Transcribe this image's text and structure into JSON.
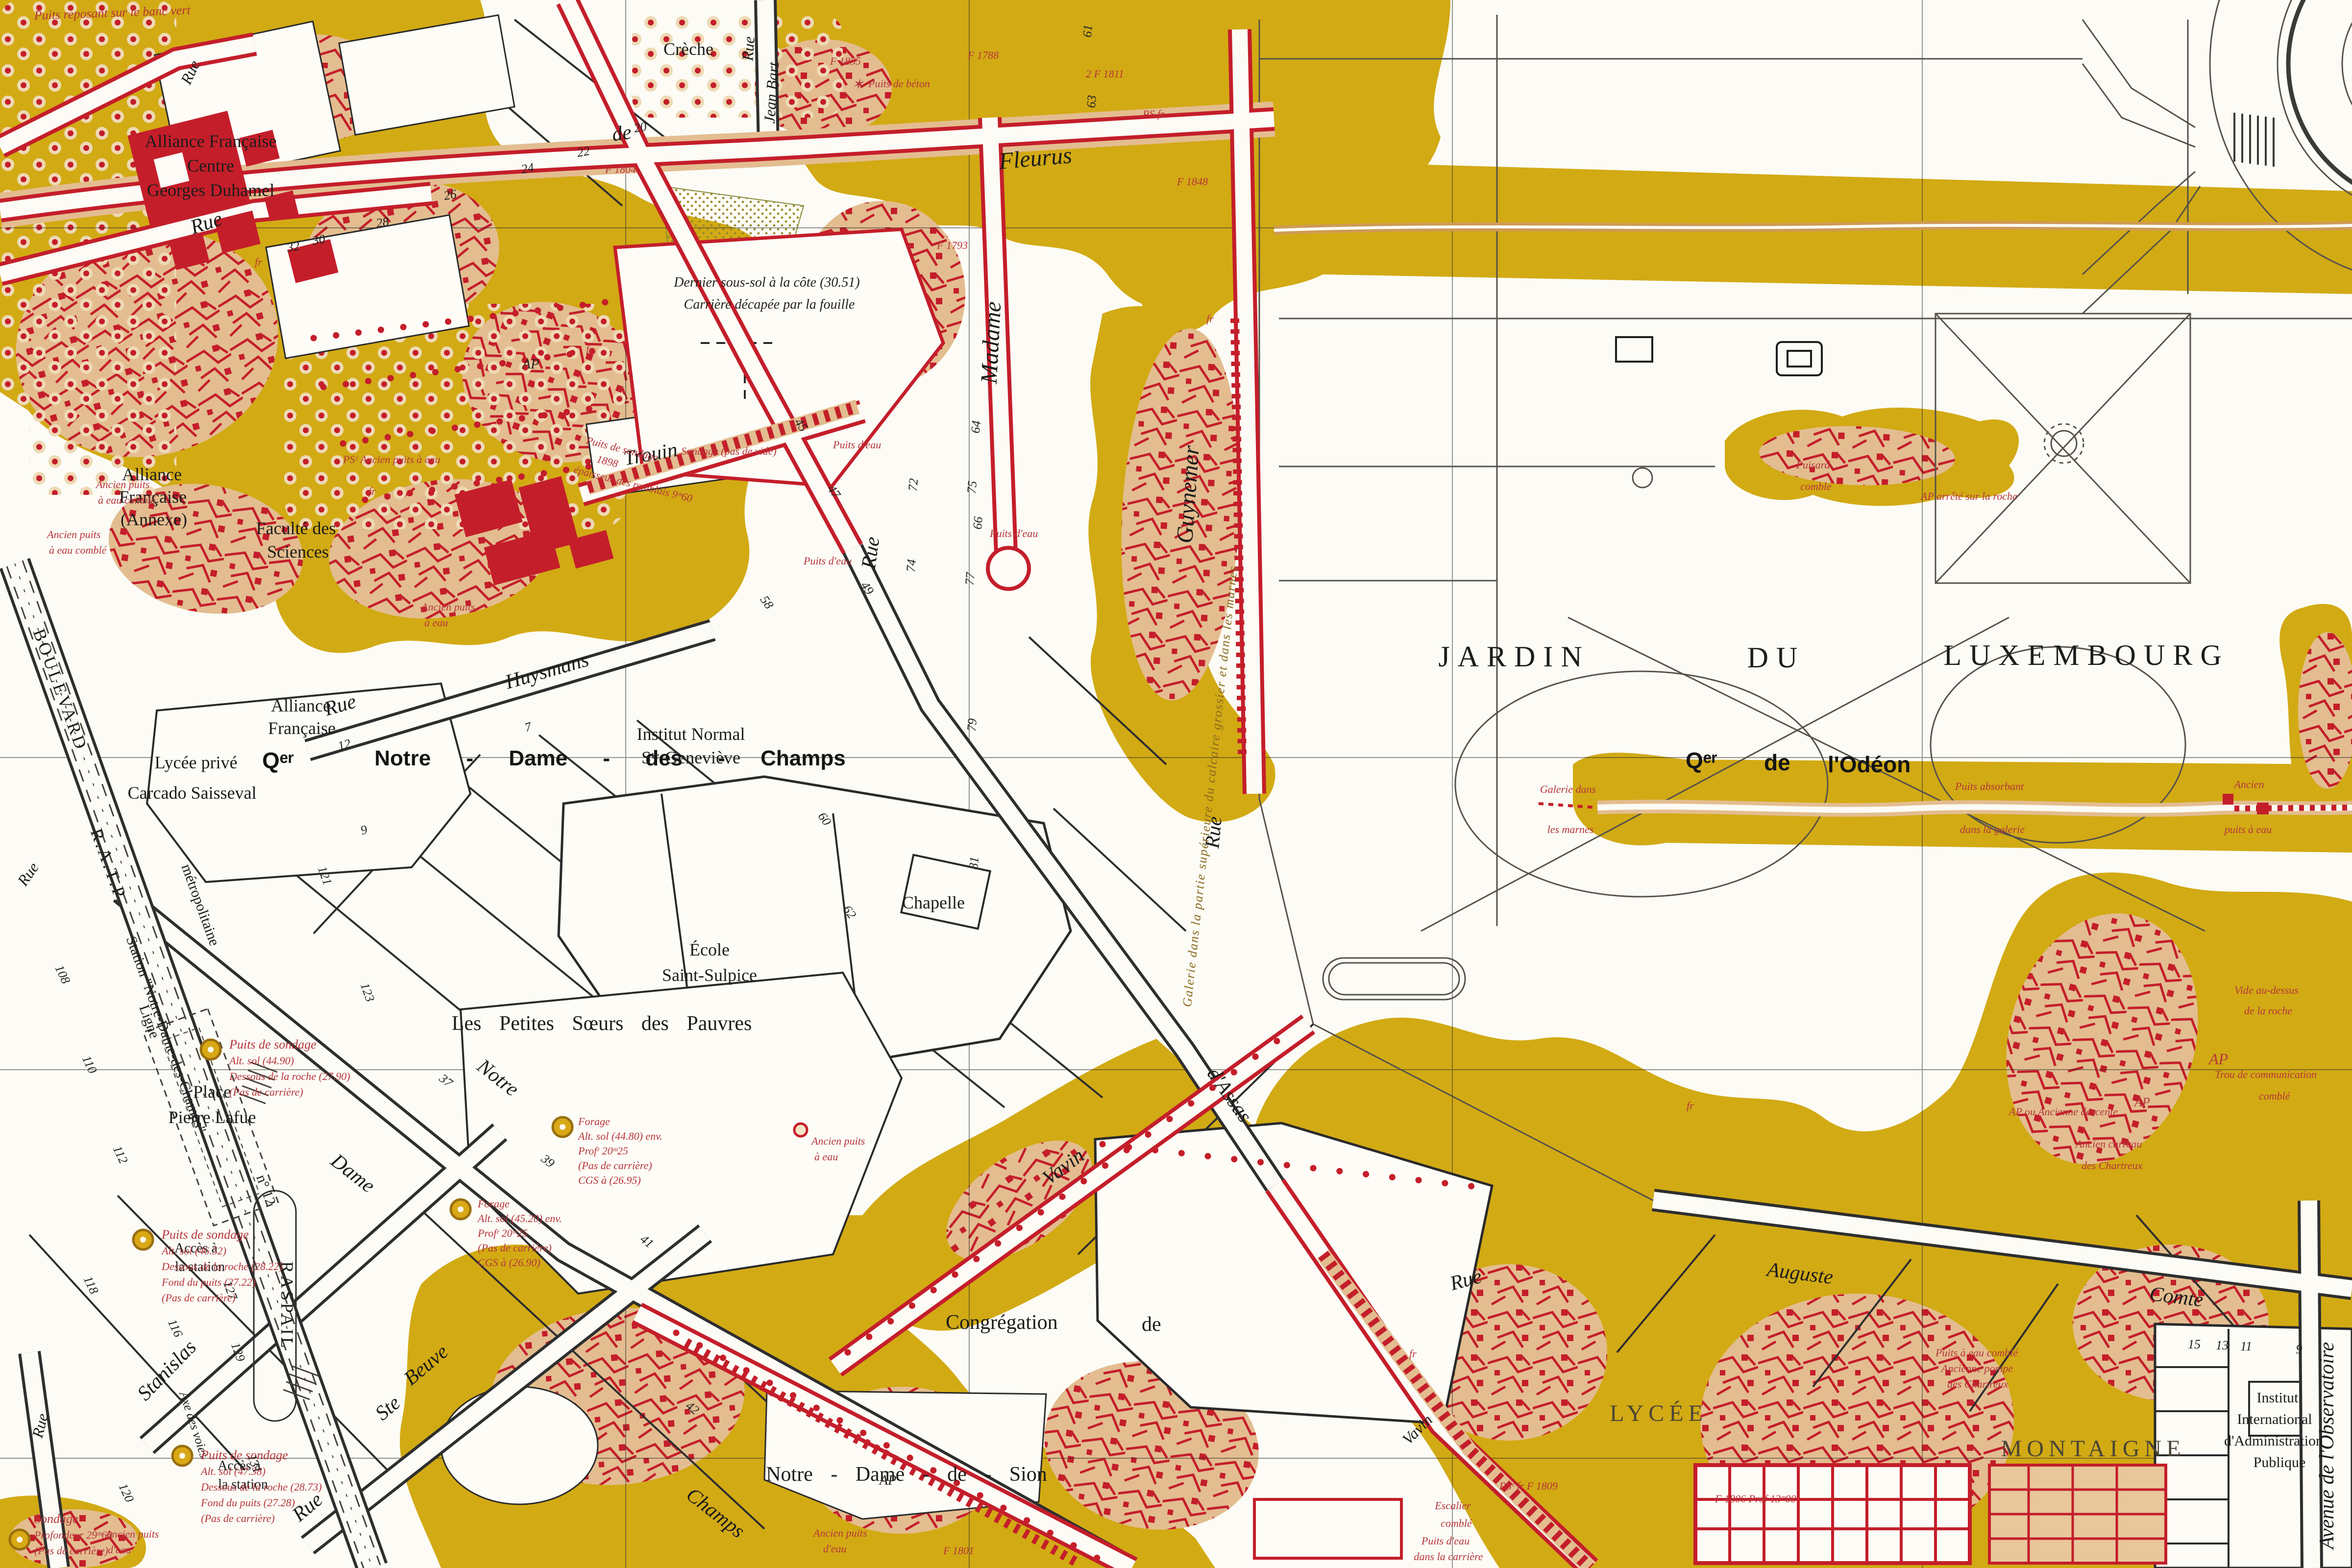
{
  "title": "Plan des anciennes carrières – quartier Notre-Dame-des-Champs / Jardin du Luxembourg",
  "colors": {
    "paper": "#fcfbf5",
    "quarry_zone_yellow": "#d2aa14",
    "gallery_tan": "#e3bd90",
    "quarry_red": "#c41e2a",
    "annotation_red": "#b5353a",
    "line_black": "#1c1c1c",
    "gallery_label_olive": "#8a6a1e"
  },
  "streets": {
    "fleurus_rue": "Rue",
    "fleurus_de": "de",
    "fleurus": "Fleurus",
    "madame": "Madame",
    "guynemer": "Guynemer",
    "jean_bart_rue": "Rue",
    "jean_bart": "Jean Bart",
    "trouin": "Trouin",
    "dassas_rue_v": "Rue",
    "dassas": "d'Assas",
    "dassas_rue_low": "Rue",
    "guynemer_rue_low": "Rue",
    "huysmans_rue": "Rue",
    "huysmans": "Huysmans",
    "ndc_notre": "Notre",
    "ndc_dame": "Dame",
    "ndc_champs": "Champs",
    "stanislas": "Stanislas",
    "stebeuve_rue": "Rue",
    "stebeuve_ste": "Ste",
    "stebeuve": "Beuve",
    "vavin": "Vavin",
    "vavin2": "Vavin",
    "auguste": "Auguste",
    "comte": "Comte",
    "observatoire": "Avenue  de  l'Observatoire",
    "rue_left": "Rue",
    "rue_bl": "Rue",
    "rue_nw": "Rue"
  },
  "places": {
    "jardin": "JARDIN",
    "du": "DU",
    "luxembourg": "LUXEMBOURG",
    "qer_ndc": "Qᵉʳ",
    "qer_ndc_name": "Notre - Dame - des - Champs",
    "qer_odeon": "Qᵉʳ",
    "qer_odeon_de": "de",
    "qer_odeon_name": "l'Odéon",
    "place_line1": "Place",
    "place_line2": "Pierre Lafue",
    "lycee": "LYCÉE",
    "montaigne": "MONTAIGNE"
  },
  "buildings": {
    "alliance1a": "Alliance Française",
    "alliance1b": "Centre",
    "alliance1c": "Georges Duhamel",
    "alliance2a": "Alliance",
    "alliance2b": "Française",
    "alliance2c": "(Annexe)",
    "alliance3a": "Alliance",
    "alliance3b": "Française",
    "faculte1": "Faculté des",
    "faculte2": "Sciences",
    "lycee_prive1": "Lycée privé",
    "lycee_prive2": "Carcado Saisseval",
    "institut1": "Institut Normal",
    "institut2": "Sᵗᵉ-Geneviève",
    "ecole1": "École",
    "ecole2": "Saint-Sulpice",
    "chapelle": "Chapelle",
    "petites": "Les Petites Sœurs des Pauvres",
    "congregation": "Congrégation",
    "congregation_de": "de",
    "sion": "Notre - Dame - de - Sion",
    "creche": "Crèche",
    "iiap1": "Institut",
    "iiap2": "International",
    "iiap3": "d'Administration",
    "iiap4": "Publique"
  },
  "metro": {
    "boulevard": "BOULEVARD",
    "ratp": "R.A.T.P.",
    "ligne": "Ligne",
    "metropolitaine": "métropolitaine",
    "station": "Station \"Notre-Dame-des-Champs\"",
    "n12": "n° 12",
    "acces1a": "Accès à",
    "acces1b": "la station",
    "acces2a": "Accès à",
    "acces2b": "la station",
    "raspail": "RASPAIL",
    "axe": "Axe des voies"
  },
  "ann": {
    "banc_vert": "Puits reposant sur le banc vert",
    "dernier": [
      "Dernier sous-sol à la côte (30.51)",
      "Carrière décapée par la fouille"
    ],
    "sondage_a": [
      "Puits de sondage",
      "Alt. sol (44.90)",
      "Dessous de la roche (27.90)",
      "(Pas de carrière)"
    ],
    "sondage_b": [
      "Puits de sondage",
      "Alt. sol (46.52)",
      "Dessous de la roche (28.22)",
      "Fond du puits (27.22)",
      "(Pas de carrière)"
    ],
    "sondage_c": [
      "Puits de sondage",
      "Alt. sol (47.38)",
      "Dessous de la roche (28.73)",
      "Fond du puits (27.28)",
      "(Pas de carrière)"
    ],
    "sondage_d": [
      "Sondage",
      "Profondeur 29ᵐ60",
      "(Pas de carrière)"
    ],
    "forage_a": [
      "Forage",
      "Alt. sol (44.80) env.",
      "Profʳ 20ᵐ25",
      "(Pas de carrière)",
      "CGS à (26.95)"
    ],
    "forage_b": [
      "Forage",
      "Alt. sol (45.20) env.",
      "Profʳ 20ᵐ25",
      "(Pas de carrière)",
      "CGS à (26.90)"
    ],
    "sondage_1898": [
      "Puits de sondage",
      "1898",
      "épaisseur des remblais 9ᵐ60"
    ],
    "sondage_pv": "Sondage (pas de vide)",
    "galerie_odeon": [
      "Galerie dans",
      "les marnes"
    ],
    "puits_absorbant": [
      "Puits absorbant",
      "dans la galerie"
    ],
    "ancien_puits_odeon": [
      "Ancien",
      "puits à eau"
    ],
    "ap_roche": "AP arrêté sur la roche",
    "puisard": [
      "Puisard",
      "comblé"
    ],
    "puits_beton": "Puits de béton",
    "galerie_calcaire": "Galerie dans la partie supérieure du calcaire grossier et dans les marnes",
    "puits_eau": "Puits d'eau",
    "ancien_puits_comble": [
      "Ancien puits",
      "à eau comblé"
    ],
    "ancien_puits_eau": [
      "Ancien puits",
      "à eau"
    ],
    "ancien_puits_deau": [
      "Ancien puits",
      "d'eau"
    ],
    "pse_ancien": "PSᶜ  Ancien puits à eau",
    "ap_descente": "AP ou Ancienne descente",
    "carreau": [
      "Ancien carreau",
      "des Chartreux"
    ],
    "trou_comm": [
      "Trou de communication",
      "comblé"
    ],
    "vide_roche": [
      "Vide au-dessus",
      "de la roche"
    ],
    "pompe": [
      "Puits à eau comblé",
      "Ancienne pompe",
      "des Chartreux"
    ],
    "escalier": [
      "Escalier",
      "comblé"
    ],
    "puits_carriere": [
      "Puits d'eau",
      "dans la carrière"
    ],
    "f1788": "F 1788",
    "f1793": "F 1793",
    "f1804": "F 1804",
    "f1848": "F 1848",
    "f1855": "F 1855",
    "f1811": "2  F 1811",
    "f1801": "F 1801",
    "f1806": "F 1806  Prof 13ᵐ00",
    "f1809": "PSᶜ fr  F 1809",
    "ap": "AP",
    "fr": "fr",
    "ps_fr": "PS fr",
    "star": "✶"
  },
  "house_numbers": [
    "121",
    "123",
    "37",
    "39",
    "41",
    "42",
    "108",
    "110",
    "112",
    "116",
    "118",
    "120",
    "127",
    "129",
    "131",
    "32",
    "30",
    "28",
    "26",
    "24",
    "22",
    "20",
    "61",
    "63",
    "64",
    "66",
    "45",
    "47",
    "49",
    "58",
    "60",
    "62",
    "72",
    "74",
    "75",
    "77",
    "79",
    "81",
    "15",
    "13",
    "11",
    "9",
    "12",
    "7",
    "9"
  ]
}
